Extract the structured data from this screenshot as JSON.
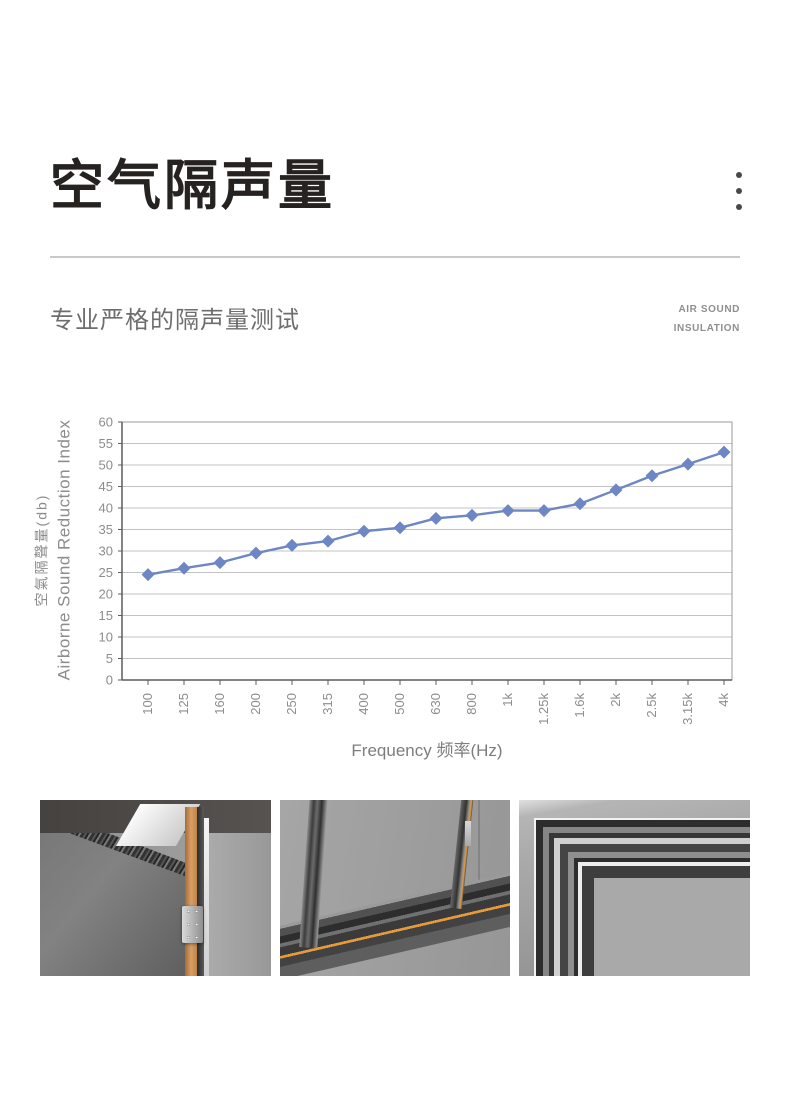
{
  "header": {
    "title": "空气隔声量",
    "menu_icon": "vertical-dots",
    "subtitle": "专业严格的隔声量测试",
    "tag_line1": "AIR SOUND",
    "tag_line2": "INSULATION"
  },
  "chart_data": {
    "type": "line",
    "categories": [
      "100",
      "125",
      "160",
      "200",
      "250",
      "315",
      "400",
      "500",
      "630",
      "800",
      "1k",
      "1.25k",
      "1.6k",
      "2k",
      "2.5k",
      "3.15k",
      "4k"
    ],
    "series": [
      {
        "name": "Airborne Sound Reduction Index 空氣隔聲量(db)",
        "values": [
          24.5,
          26,
          27.3,
          29.5,
          31.3,
          32.3,
          34.6,
          35.4,
          37.6,
          38.3,
          39.4,
          39.4,
          41,
          44.2,
          47.5,
          50.2,
          53
        ]
      }
    ],
    "xlabel": "Frequency 频率(Hz)",
    "ylabel_cn": "空氣隔聲量(db)",
    "ylabel_en": "Airborne Sound Reduction Index",
    "ylim": [
      0,
      60
    ],
    "ytick_step": 5,
    "yticks": [
      0,
      5,
      10,
      15,
      20,
      25,
      30,
      35,
      40,
      45,
      50,
      55,
      60
    ],
    "grid": true,
    "legend": "none",
    "marker": "diamond",
    "line_color": "#6d87c4",
    "axis_text_color": "#8d8d8d",
    "grid_color": "#c3c3c3",
    "axis_color": "#5c5c5c"
  },
  "gallery": {
    "images": [
      {
        "name": "door-frame-top-corner-render"
      },
      {
        "name": "window-sill-corner-render"
      },
      {
        "name": "frame-profile-corner-render"
      }
    ]
  }
}
